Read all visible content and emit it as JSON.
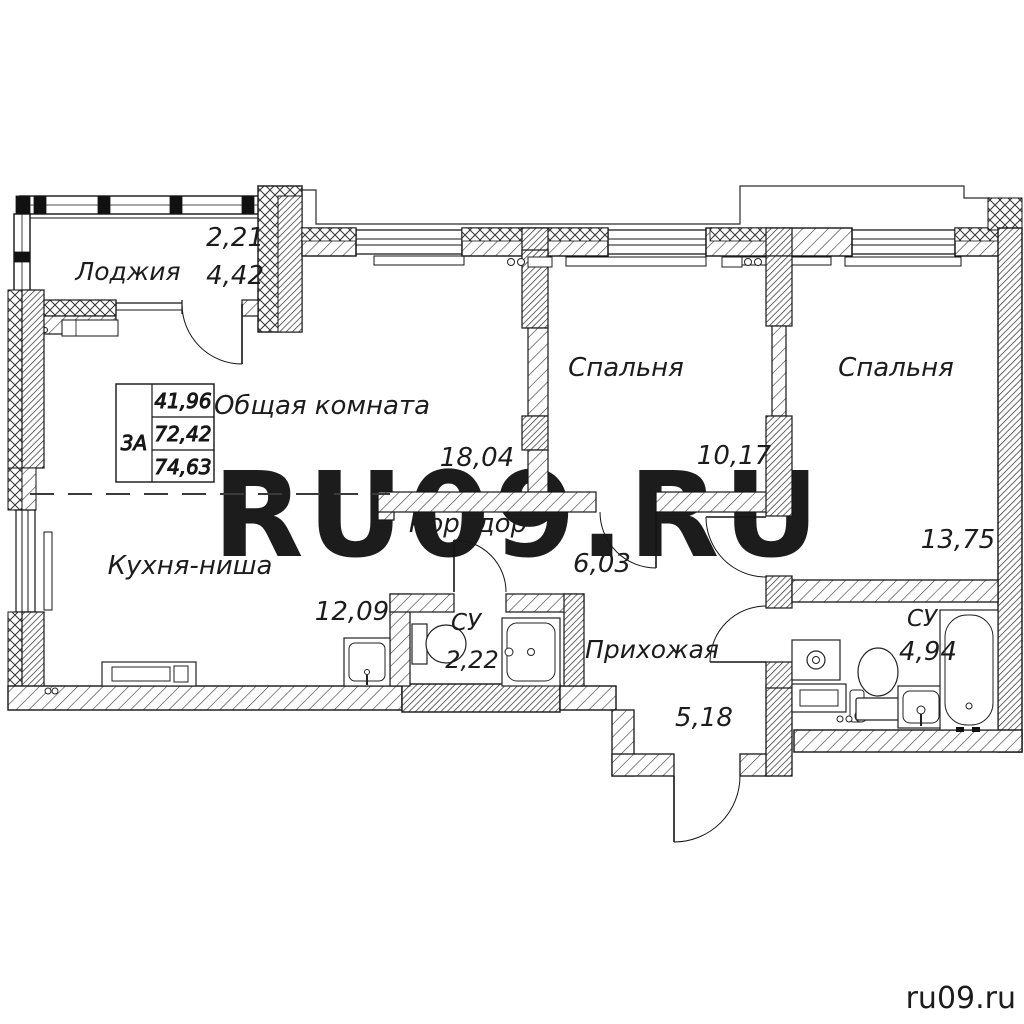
{
  "watermark": {
    "center": "RU09.RU",
    "corner": "ru09.ru"
  },
  "info_table": {
    "unit": "3А",
    "values": [
      "41,96",
      "72,42",
      "74,63"
    ]
  },
  "rooms": {
    "loggia": {
      "name": "Лоджия",
      "area_half": "2,21",
      "area": "4,42"
    },
    "living": {
      "name": "Общая комната",
      "area": "18,04"
    },
    "bedroom1": {
      "name": "Спальня",
      "area": "10,17"
    },
    "bedroom2": {
      "name": "Спальня",
      "area": "13,75"
    },
    "kitchen": {
      "name": "Кухня-ниша",
      "area": "12,09"
    },
    "corridor": {
      "name": "Коридор",
      "area": "6,03"
    },
    "bath_small": {
      "name": "СУ",
      "area": "2,22"
    },
    "hall": {
      "name": "Прихожая",
      "area": "5,18"
    },
    "bath_big": {
      "name": "СУ",
      "area": "4,94"
    }
  },
  "colors": {
    "line": "#1c1c1c",
    "watermark": "#ececec",
    "corner_text": "#949494"
  }
}
